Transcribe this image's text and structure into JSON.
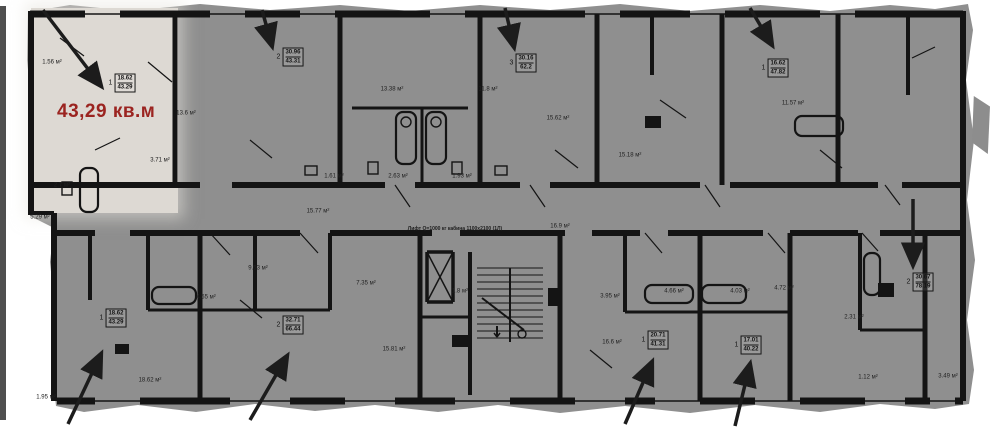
{
  "highlight": {
    "area_text": "43,29 кв.м",
    "color": "#9b2420"
  },
  "apartment_labels": [
    {
      "num": "1",
      "top": "18.62",
      "bottom": "43.29",
      "x": 122,
      "y": 83
    },
    {
      "num": "2",
      "top": "30.96",
      "bottom": "43.31",
      "x": 290,
      "y": 57
    },
    {
      "num": "3",
      "top": "30.16",
      "bottom": "62.2",
      "x": 523,
      "y": 63
    },
    {
      "num": "1",
      "top": "16.62",
      "bottom": "47.82",
      "x": 775,
      "y": 68
    },
    {
      "num": "1",
      "top": "18.62",
      "bottom": "43.29",
      "x": 113,
      "y": 318
    },
    {
      "num": "2",
      "top": "32.71",
      "bottom": "66.44",
      "x": 290,
      "y": 325
    },
    {
      "num": "1",
      "top": "20.71",
      "bottom": "41.31",
      "x": 655,
      "y": 340
    },
    {
      "num": "1",
      "top": "17.01",
      "bottom": "40.22",
      "x": 748,
      "y": 345
    },
    {
      "num": "2",
      "top": "30.67",
      "bottom": "78.19",
      "x": 920,
      "y": 282
    }
  ],
  "room_labels": [
    {
      "text": "1.56 м²",
      "x": 52,
      "y": 63
    },
    {
      "text": "3.71 м²",
      "x": 160,
      "y": 161
    },
    {
      "text": "2.7 м²",
      "x": 62,
      "y": 186
    },
    {
      "text": "5.29 м²",
      "x": 40,
      "y": 218
    },
    {
      "text": "13.6 м²",
      "x": 186,
      "y": 114
    },
    {
      "text": "13.38 м²",
      "x": 392,
      "y": 90
    },
    {
      "text": "11.8 м²",
      "x": 488,
      "y": 90
    },
    {
      "text": "15.62 м²",
      "x": 558,
      "y": 119
    },
    {
      "text": "15.18 м²",
      "x": 630,
      "y": 156
    },
    {
      "text": "11.57 м²",
      "x": 793,
      "y": 104
    },
    {
      "text": "1.61 м²",
      "x": 334,
      "y": 177
    },
    {
      "text": "2.63 м²",
      "x": 398,
      "y": 177
    },
    {
      "text": "1.93 м²",
      "x": 462,
      "y": 177
    },
    {
      "text": "15.77 м²",
      "x": 318,
      "y": 212
    },
    {
      "text": "16.9 м²",
      "x": 560,
      "y": 227
    },
    {
      "text": "18.62 м²",
      "x": 150,
      "y": 381
    },
    {
      "text": "1.95 м²",
      "x": 46,
      "y": 398
    },
    {
      "text": "9.53 м²",
      "x": 258,
      "y": 269
    },
    {
      "text": "4.55 м²",
      "x": 206,
      "y": 298
    },
    {
      "text": "7.35 м²",
      "x": 366,
      "y": 284
    },
    {
      "text": "15.81 м²",
      "x": 394,
      "y": 350
    },
    {
      "text": "1.8 м²",
      "x": 460,
      "y": 292
    },
    {
      "text": "3.95 м²",
      "x": 610,
      "y": 297
    },
    {
      "text": "4.66 м²",
      "x": 674,
      "y": 292
    },
    {
      "text": "4.03 м²",
      "x": 740,
      "y": 292
    },
    {
      "text": "4.72 м²",
      "x": 784,
      "y": 289
    },
    {
      "text": "16.6 м²",
      "x": 612,
      "y": 343
    },
    {
      "text": "2.31 м²",
      "x": 854,
      "y": 318
    },
    {
      "text": "1.12 м²",
      "x": 868,
      "y": 378
    },
    {
      "text": "3.49 м²",
      "x": 948,
      "y": 377
    }
  ],
  "notes": [
    {
      "text": "Лифт Q=1000 кг кабина 1100х2100 (1Л)",
      "x": 455,
      "y": 229
    }
  ],
  "arrows": [
    {
      "x1": 43,
      "y1": 10,
      "x2": 101,
      "y2": 86
    },
    {
      "x1": 262,
      "y1": 10,
      "x2": 272,
      "y2": 46
    },
    {
      "x1": 505,
      "y1": 8,
      "x2": 514,
      "y2": 47
    },
    {
      "x1": 750,
      "y1": 8,
      "x2": 772,
      "y2": 45
    },
    {
      "x1": 913,
      "y1": 199,
      "x2": 913,
      "y2": 265
    },
    {
      "x1": 68,
      "y1": 424,
      "x2": 101,
      "y2": 354
    },
    {
      "x1": 250,
      "y1": 420,
      "x2": 287,
      "y2": 356
    },
    {
      "x1": 625,
      "y1": 424,
      "x2": 652,
      "y2": 362
    },
    {
      "x1": 735,
      "y1": 426,
      "x2": 750,
      "y2": 364
    }
  ],
  "colors": {
    "plan_bg": "#8f8f8f",
    "highlight_bg": "#ddd9d3",
    "wall": "#141414",
    "paper": "#ffffff",
    "edge_strip": "#4f4f4f",
    "red_text": "#9b2420"
  }
}
